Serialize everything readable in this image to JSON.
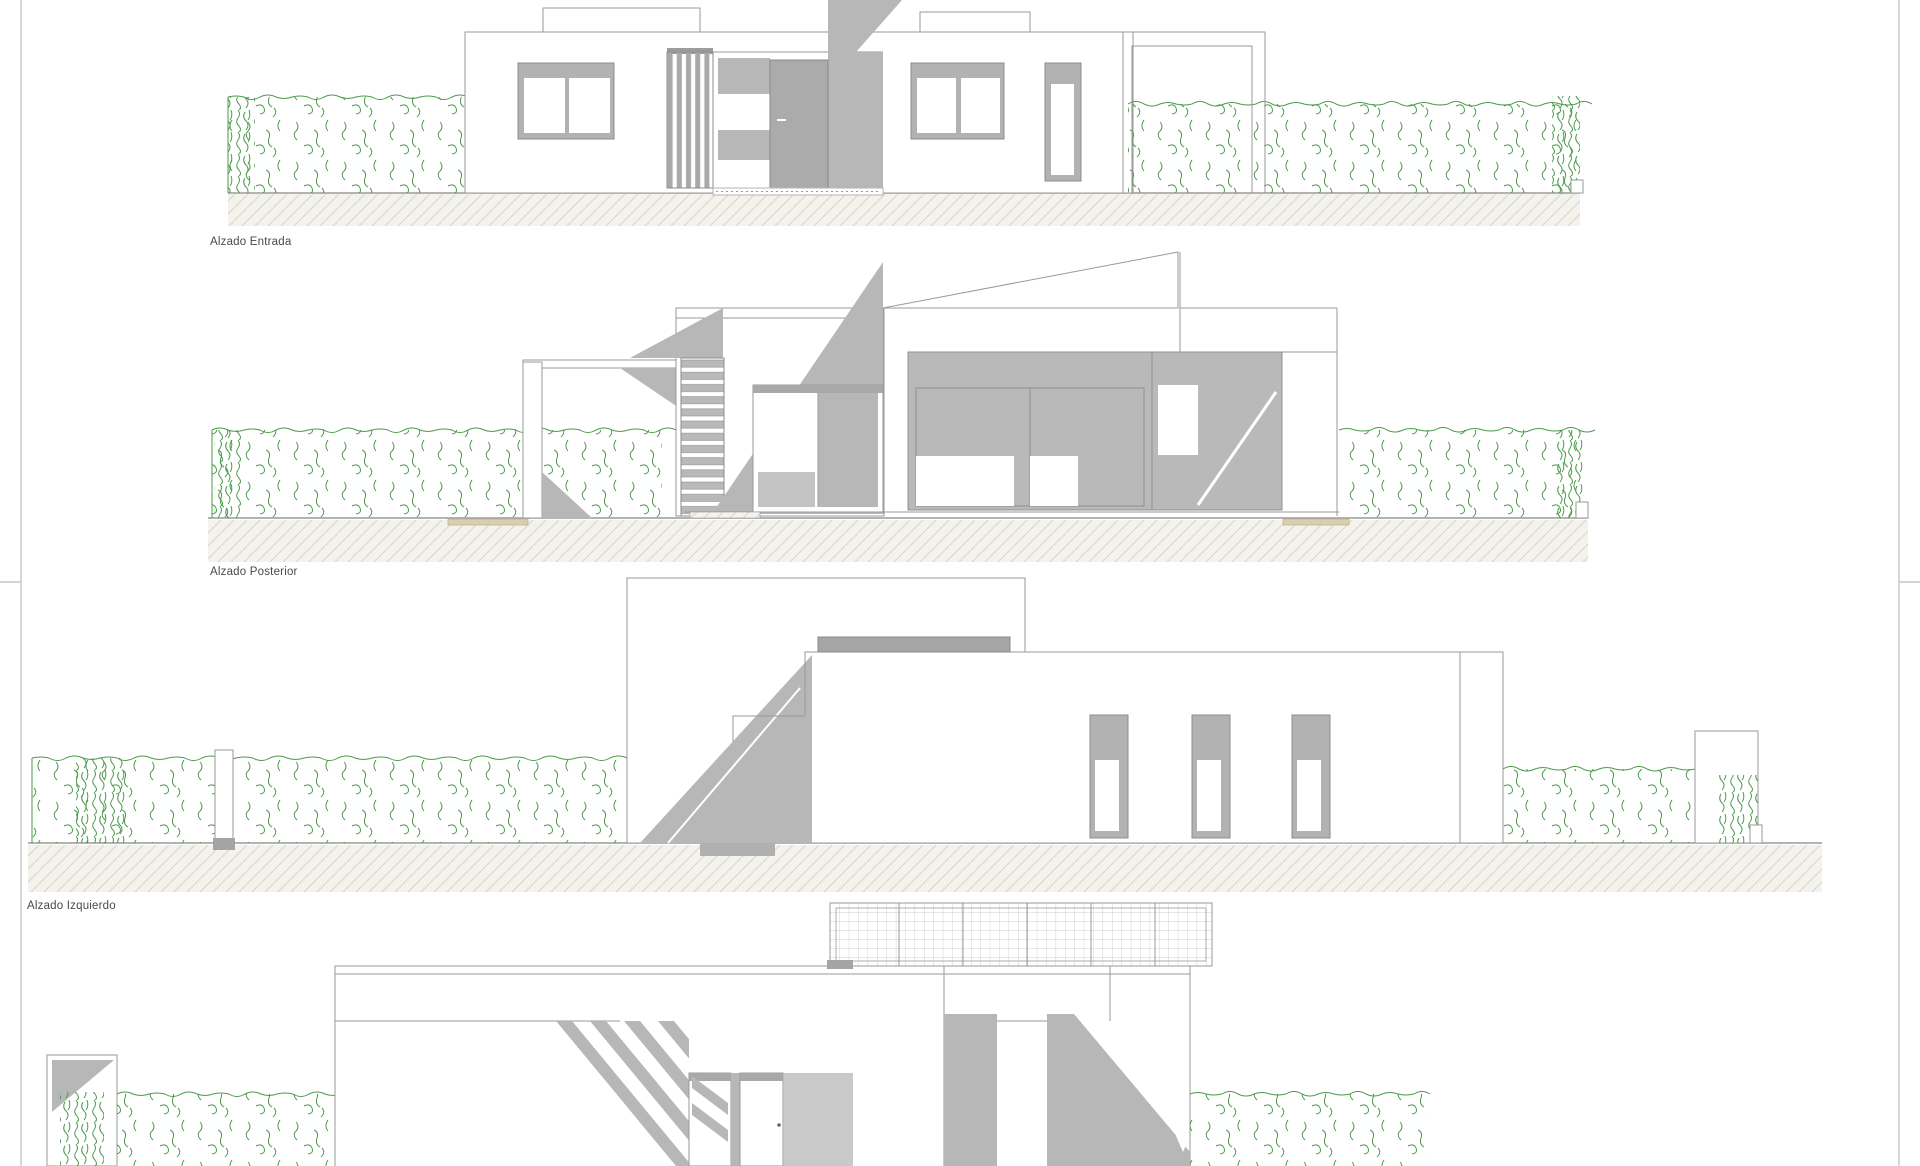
{
  "document": {
    "type": "architectural-elevation-sheet",
    "sheet_background": "#ffffff"
  },
  "labels": {
    "entrada": "Alzado Entrada",
    "posterior": "Alzado Posterior",
    "izquierdo": "Alzado Izquierdo"
  },
  "colors": {
    "line": "#9a9a9a",
    "line-light": "#c6c6c6",
    "shadow": "#b7b7b7",
    "shadow-dark": "#a4a4a4",
    "frame": "#b2b2b2",
    "veg": "#4a9b4a",
    "hatch-bg": "#f3f2ec",
    "hatch-line": "#d7d5c8",
    "border": "#c6c6c6",
    "label": "#4a4a4a"
  }
}
